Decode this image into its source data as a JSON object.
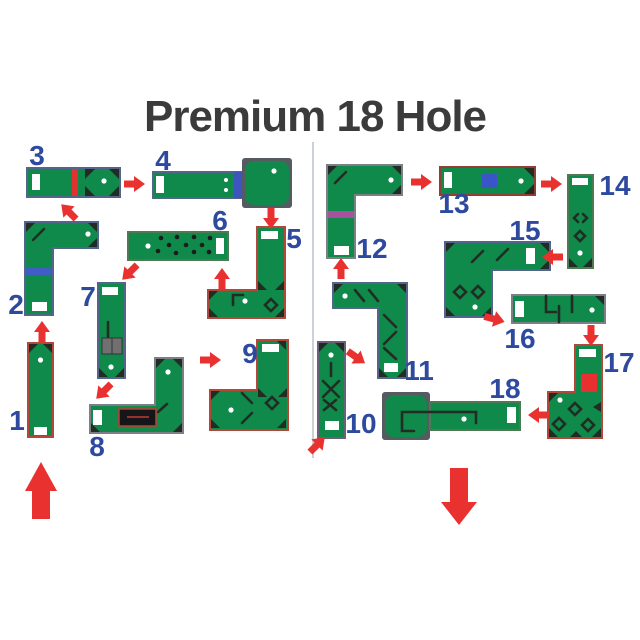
{
  "title": "Premium 18 Hole",
  "holes": [
    {
      "num": "1"
    },
    {
      "num": "2"
    },
    {
      "num": "3"
    },
    {
      "num": "4"
    },
    {
      "num": "5"
    },
    {
      "num": "6"
    },
    {
      "num": "7"
    },
    {
      "num": "8"
    },
    {
      "num": "9"
    },
    {
      "num": "10"
    },
    {
      "num": "11"
    },
    {
      "num": "12"
    },
    {
      "num": "13"
    },
    {
      "num": "14"
    },
    {
      "num": "15"
    },
    {
      "num": "16"
    },
    {
      "num": "17"
    },
    {
      "num": "18"
    }
  ],
  "flow": {
    "sequence_arrows": [
      "1-2",
      "2-3",
      "3-4",
      "4-5",
      "5-6",
      "6-7",
      "7-8",
      "8-9",
      "9-10",
      "10-11",
      "11-12",
      "12-13",
      "13-14",
      "14-15",
      "15-16",
      "16-17",
      "17-18"
    ],
    "start_arrow_direction": "up",
    "finish_arrow_direction": "down"
  },
  "colors": {
    "felt_green": "#0f8a4a",
    "arrow_red": "#e93130",
    "number_blue": "#2e4a9e",
    "title_gray": "#3b3b3b",
    "tee_white": "#ffffff"
  }
}
